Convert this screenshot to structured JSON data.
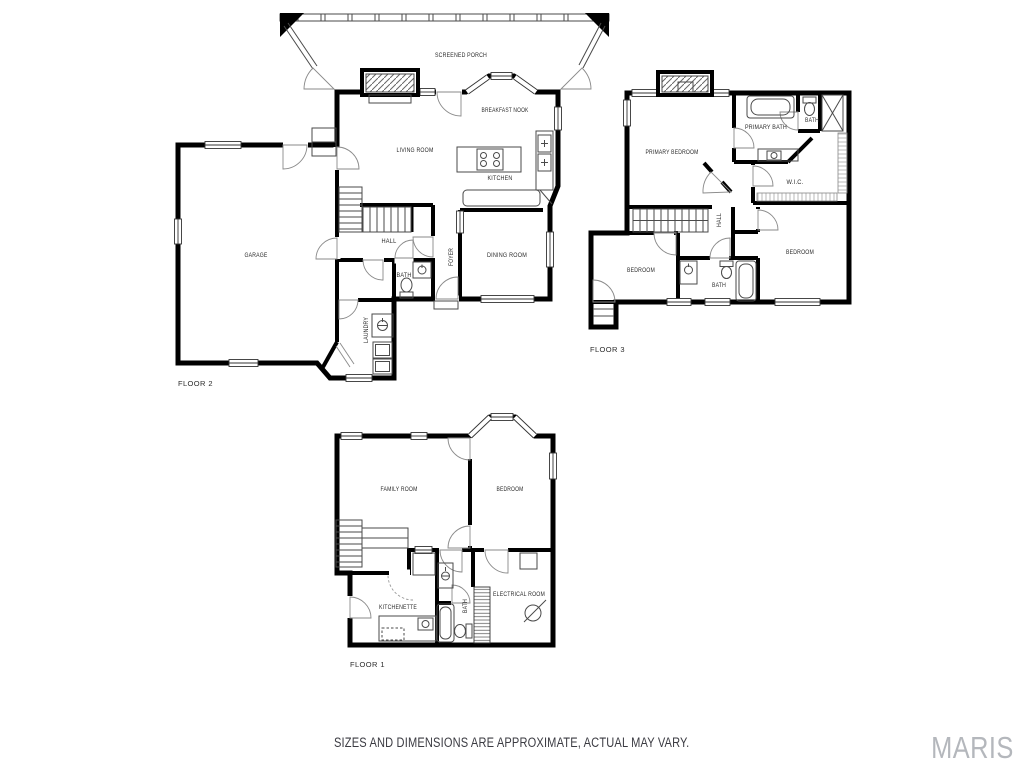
{
  "page": {
    "disclaimer": "SIZES AND DIMENSIONS ARE APPROXIMATE, ACTUAL MAY VARY.",
    "watermark": "MARIS"
  },
  "colors": {
    "wall": "#000000",
    "label": "#2b2b2b",
    "fixture": "#4a4a4a",
    "watermark": "#b4b7bc",
    "background": "#ffffff"
  },
  "floors": {
    "floor2": {
      "name": "FLOOR 2",
      "rooms": {
        "screened_porch": "SCREENED PORCH",
        "breakfast_nook": "BREAKFAST NOOK",
        "living_room": "LIVING ROOM",
        "kitchen": "KITCHEN",
        "garage": "GARAGE",
        "hall": "HALL",
        "bath": "BATH",
        "foyer": "FOYER",
        "dining_room": "DINING ROOM",
        "laundry": "LAUNDRY"
      }
    },
    "floor3": {
      "name": "FLOOR 3",
      "rooms": {
        "primary_bedroom": "PRIMARY BEDROOM",
        "primary_bath": "PRIMARY BATH",
        "bath_upper": "BATH",
        "wic": "W.I.C.",
        "hall": "HALL",
        "bedroom_left": "BEDROOM",
        "bedroom_right": "BEDROOM",
        "bath_lower": "BATH"
      }
    },
    "floor1": {
      "name": "FLOOR 1",
      "rooms": {
        "family_room": "FAMILY ROOM",
        "bedroom": "BEDROOM",
        "kitchenette": "KITCHENETTE",
        "bath": "BATH",
        "electrical_room": "ELECTRICAL ROOM"
      }
    }
  }
}
